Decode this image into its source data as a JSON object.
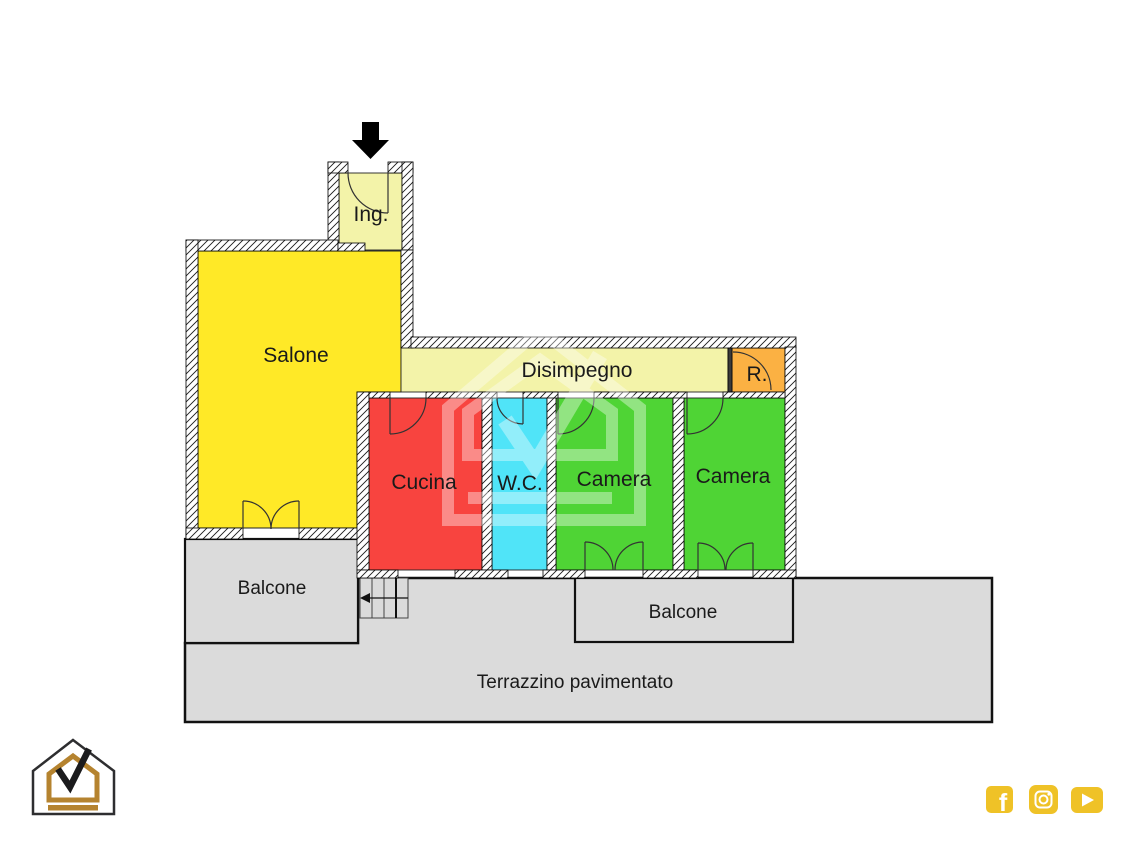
{
  "plan": {
    "type": "apartment-floor-plan",
    "rooms": {
      "ingresso": "Ing.",
      "salone": "Salone",
      "disimpegno": "Disimpegno",
      "ripostiglio": "R.",
      "cucina": "Cucina",
      "wc": "W.C.",
      "camera1": "Camera",
      "camera2": "Camera",
      "balcone_left": "Balcone",
      "balcone_right": "Balcone",
      "terrazzino": "Terrazzino pavimentato"
    }
  },
  "colors": {
    "salone": "#ffe927",
    "ingresso": "#f3f3a9",
    "disimpegno": "#f3f3a9",
    "ripostiglio": "#fbb143",
    "cucina": "#f8443f",
    "wc": "#50e4f8",
    "camera": "#4fd435",
    "outdoor": "#dbdbdb",
    "wall_line": "#1b1b1b",
    "arrow": "#000000",
    "brand_gold": "#b5832f",
    "brand_dark": "#2e2e30",
    "social_gold": "#efc227",
    "label_text": "#1a1a1a"
  },
  "icons": {
    "entrance_arrow": "entrance-arrow",
    "logo": "house-check-logo",
    "watermark": "house-check-watermark",
    "social": [
      {
        "name": "facebook-icon",
        "glyph": "f"
      },
      {
        "name": "instagram-icon"
      },
      {
        "name": "youtube-icon"
      }
    ]
  }
}
